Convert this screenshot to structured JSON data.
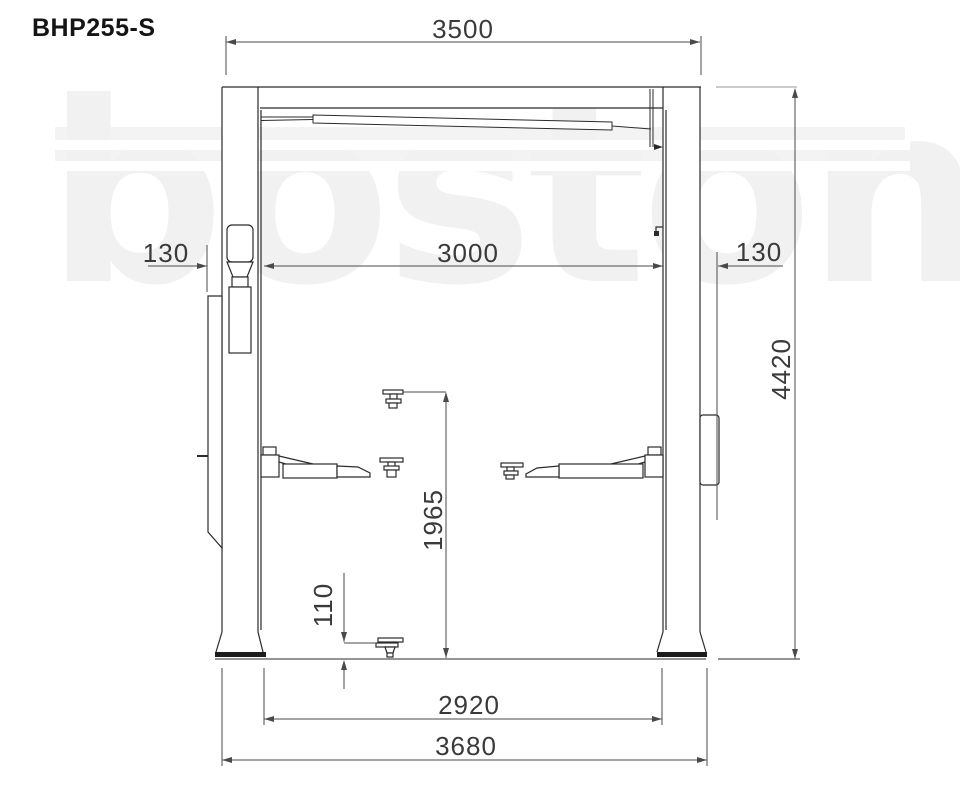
{
  "title": "BHP255-S",
  "watermark": "boston",
  "dimensions": {
    "overall_width": "3500",
    "clear_width": "3000",
    "left_offset": "130",
    "right_offset": "130",
    "overall_height": "4420",
    "lift_height": "1965",
    "pad_min_height": "110",
    "base_inner_span": "2920",
    "base_overall_span": "3680"
  },
  "colors": {
    "structure_line": "#2b2b2b",
    "dimension_line": "#4a4a4a",
    "label_text": "#3a3a3a",
    "watermark_gray": "#f1f1f1",
    "background": "#ffffff"
  }
}
